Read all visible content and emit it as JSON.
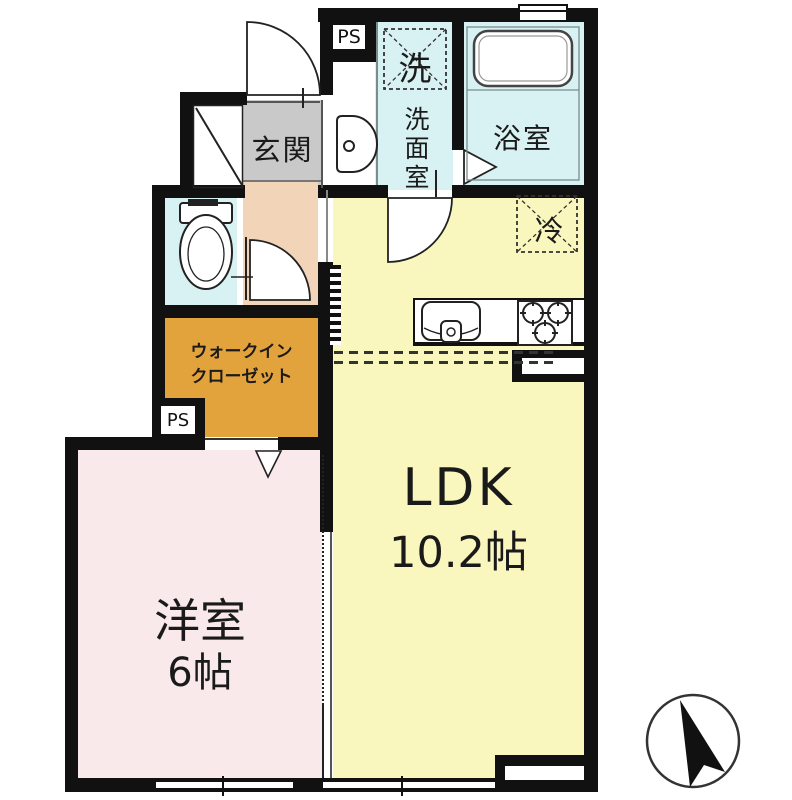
{
  "plan_title": "apartment-floorplan",
  "colors": {
    "wall": "#111111",
    "ldk": "#FAF7BE",
    "bedroom": "#F9E9EB",
    "hall": "#F2D5B8",
    "entrance": "#C9C9C9",
    "wet": "#D8F1F2",
    "closet": "#E3A33C"
  },
  "rooms": {
    "ldk": {
      "name": "LDK",
      "size": "10.2帖"
    },
    "bedroom": {
      "name": "洋室",
      "size": "6帖"
    },
    "entrance": {
      "name": "玄関"
    },
    "washroom": {
      "name": "洗面室"
    },
    "bathroom": {
      "name": "浴室"
    },
    "walk_in_closet": {
      "name_line1": "ウォークイン",
      "name_line2": "クローゼット"
    }
  },
  "symbols": {
    "washer_space": "洗",
    "refrigerator_space": "冷",
    "pipe_space_top": "PS",
    "pipe_space_bottom": "PS"
  }
}
